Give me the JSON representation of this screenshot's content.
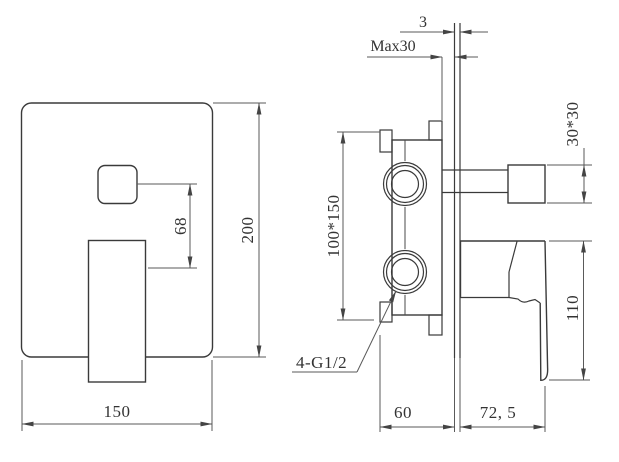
{
  "colors": {
    "background": "#ffffff",
    "object_line": "#3a3a3a",
    "dimension_line": "#5a5a5a",
    "text": "#333333"
  },
  "front_view": {
    "plate_width": "150",
    "plate_height": "200",
    "diverter_to_handle_offset": "68"
  },
  "side_view": {
    "trim_plate_thickness": "3",
    "max_wall_thickness": "Max30",
    "knob_size": "30*30",
    "valve_body_size": "100*150",
    "handle_drop": "110",
    "embed_depth": "60",
    "protrusion": "72, 5",
    "thread_callout": "4-G1/2"
  }
}
